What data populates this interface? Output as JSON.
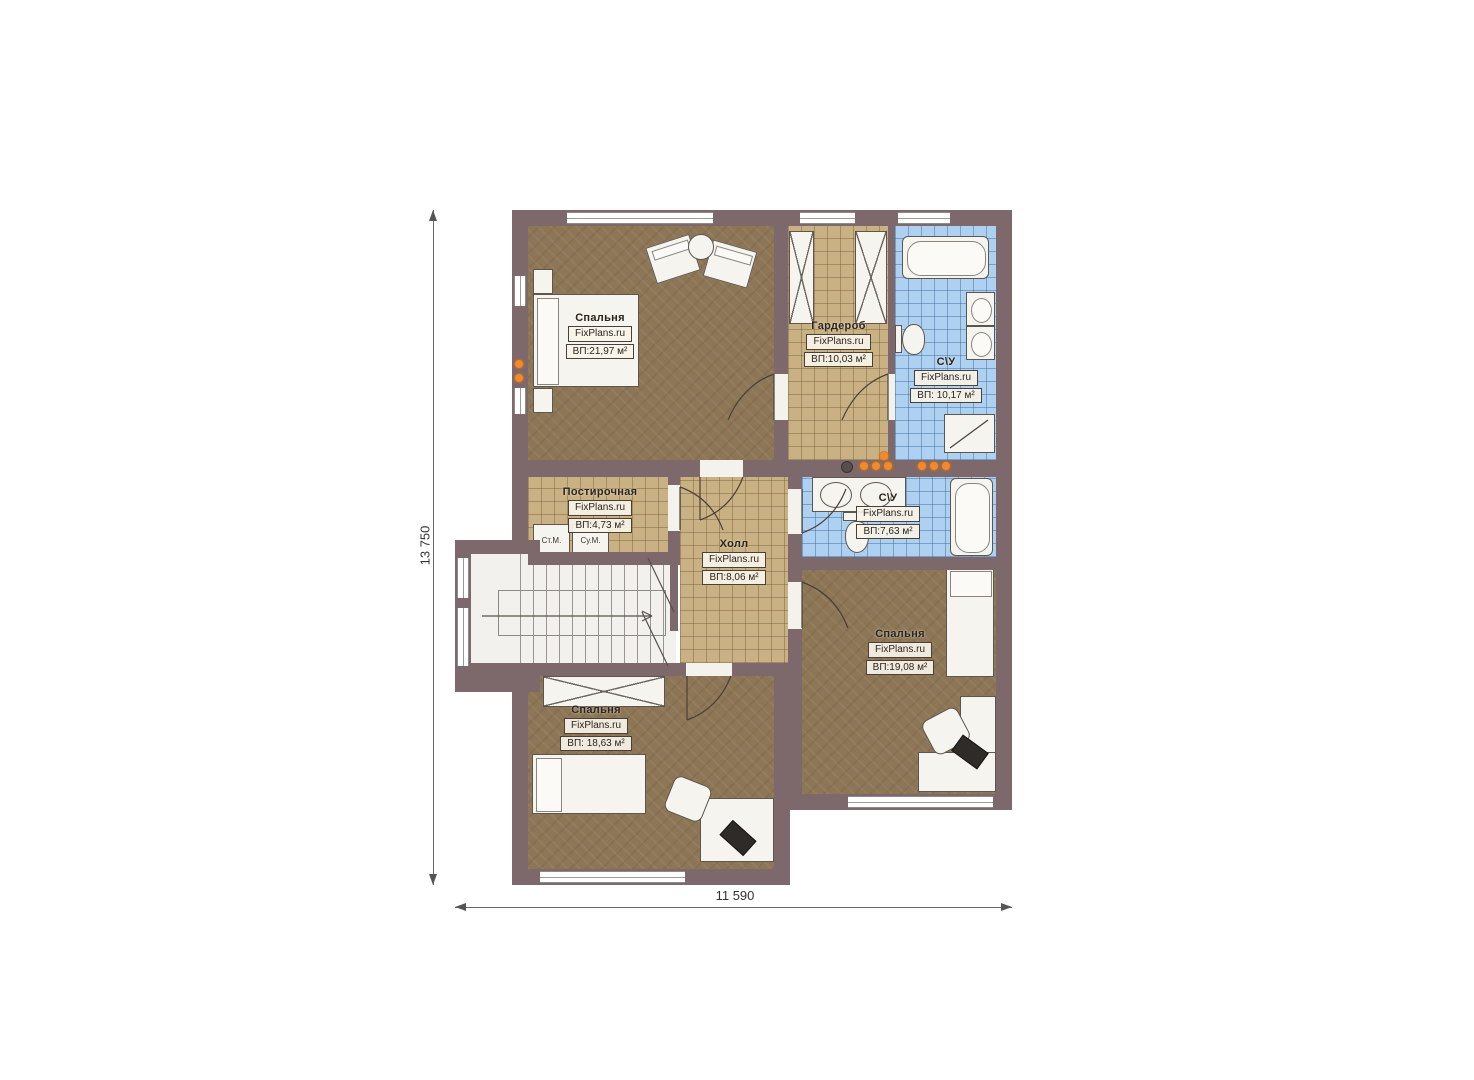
{
  "plan": {
    "title": "Second floor plan",
    "brand_watermark": "FixPlans.ru",
    "dims": {
      "height": "13 750",
      "width": "11 590"
    },
    "rooms": {
      "bedroom1": {
        "name": "Спальня",
        "brand": "FixPlans.ru",
        "area": "ВП:21,97 м²"
      },
      "wardrobe": {
        "name": "Гардероб",
        "brand": "FixPlans.ru",
        "area": "ВП:10,03 м²"
      },
      "bath1": {
        "name": "С\\У",
        "brand": "FixPlans.ru",
        "area": "ВП: 10,17 м²"
      },
      "laundry": {
        "name": "Постирочная",
        "brand": "FixPlans.ru",
        "area": "ВП:4,73 м²"
      },
      "hall": {
        "name": "Холл",
        "brand": "FixPlans.ru",
        "area": "ВП:8,06 м²"
      },
      "bath2": {
        "name": "С\\У",
        "brand": "FixPlans.ru",
        "area": "ВП:7,63 м²"
      },
      "bedroom2": {
        "name": "Спальня",
        "brand": "FixPlans.ru",
        "area": "ВП:19,08 м²"
      },
      "bedroom3": {
        "name": "Спальня",
        "brand": "FixPlans.ru",
        "area": "ВП: 18,63 м²"
      }
    },
    "appliances": {
      "washer": "Ст.М.",
      "dryer": "Су.М."
    },
    "colors": {
      "wall": "#7d686b",
      "carpet": "#8d7655",
      "tile_beige": "#c9b183",
      "tile_blue": "#aed1f2",
      "fixture_white": "#f5f4ef",
      "accent_orange": "#f08a2e"
    }
  }
}
